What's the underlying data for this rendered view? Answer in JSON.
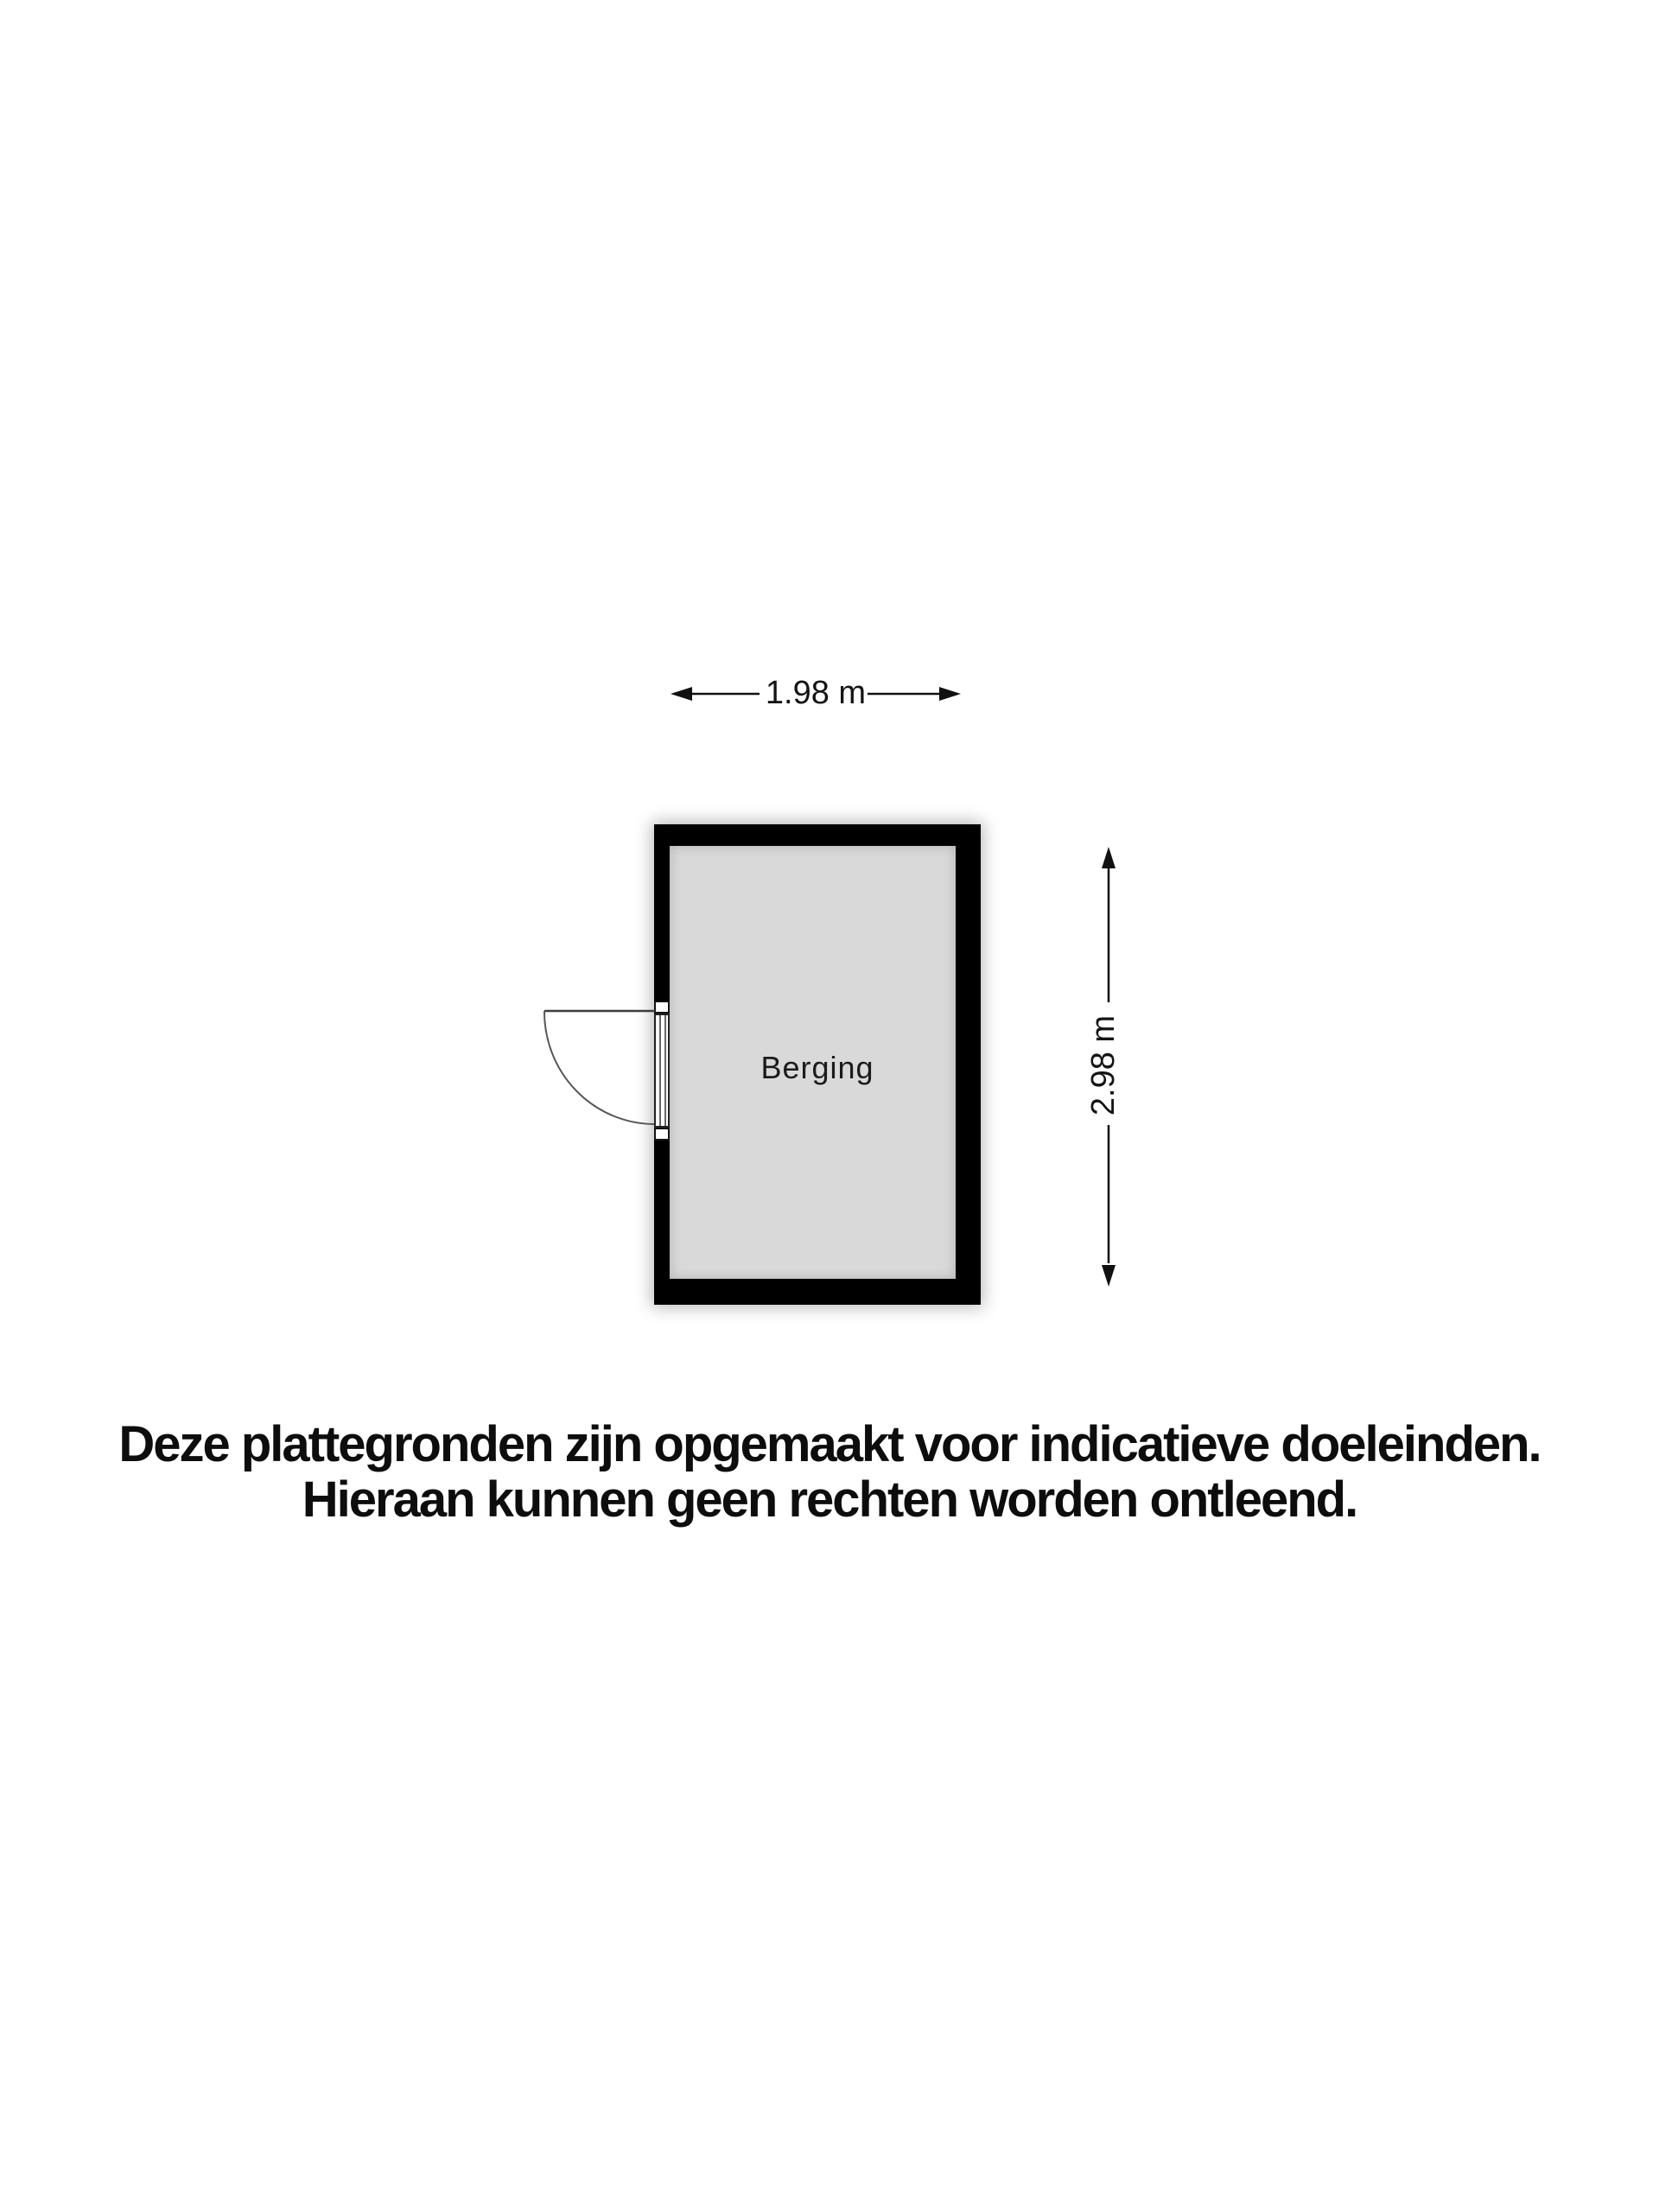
{
  "floorplan": {
    "room": {
      "label": "Berging"
    },
    "dimensions": {
      "width_label": "1.98 m",
      "height_label": "2.98 m"
    },
    "disclaimer": {
      "line1": "Deze plattegronden zijn opgemaakt voor indicatieve doeleinden.",
      "line2": "Hieraan kunnen geen rechten worden ontleend."
    },
    "colors": {
      "wall": "#000000",
      "floor": "#d9d9d9",
      "background": "#ffffff",
      "line": "#1a1a1a",
      "door": "#4a4a4a",
      "text": "#111111"
    }
  }
}
